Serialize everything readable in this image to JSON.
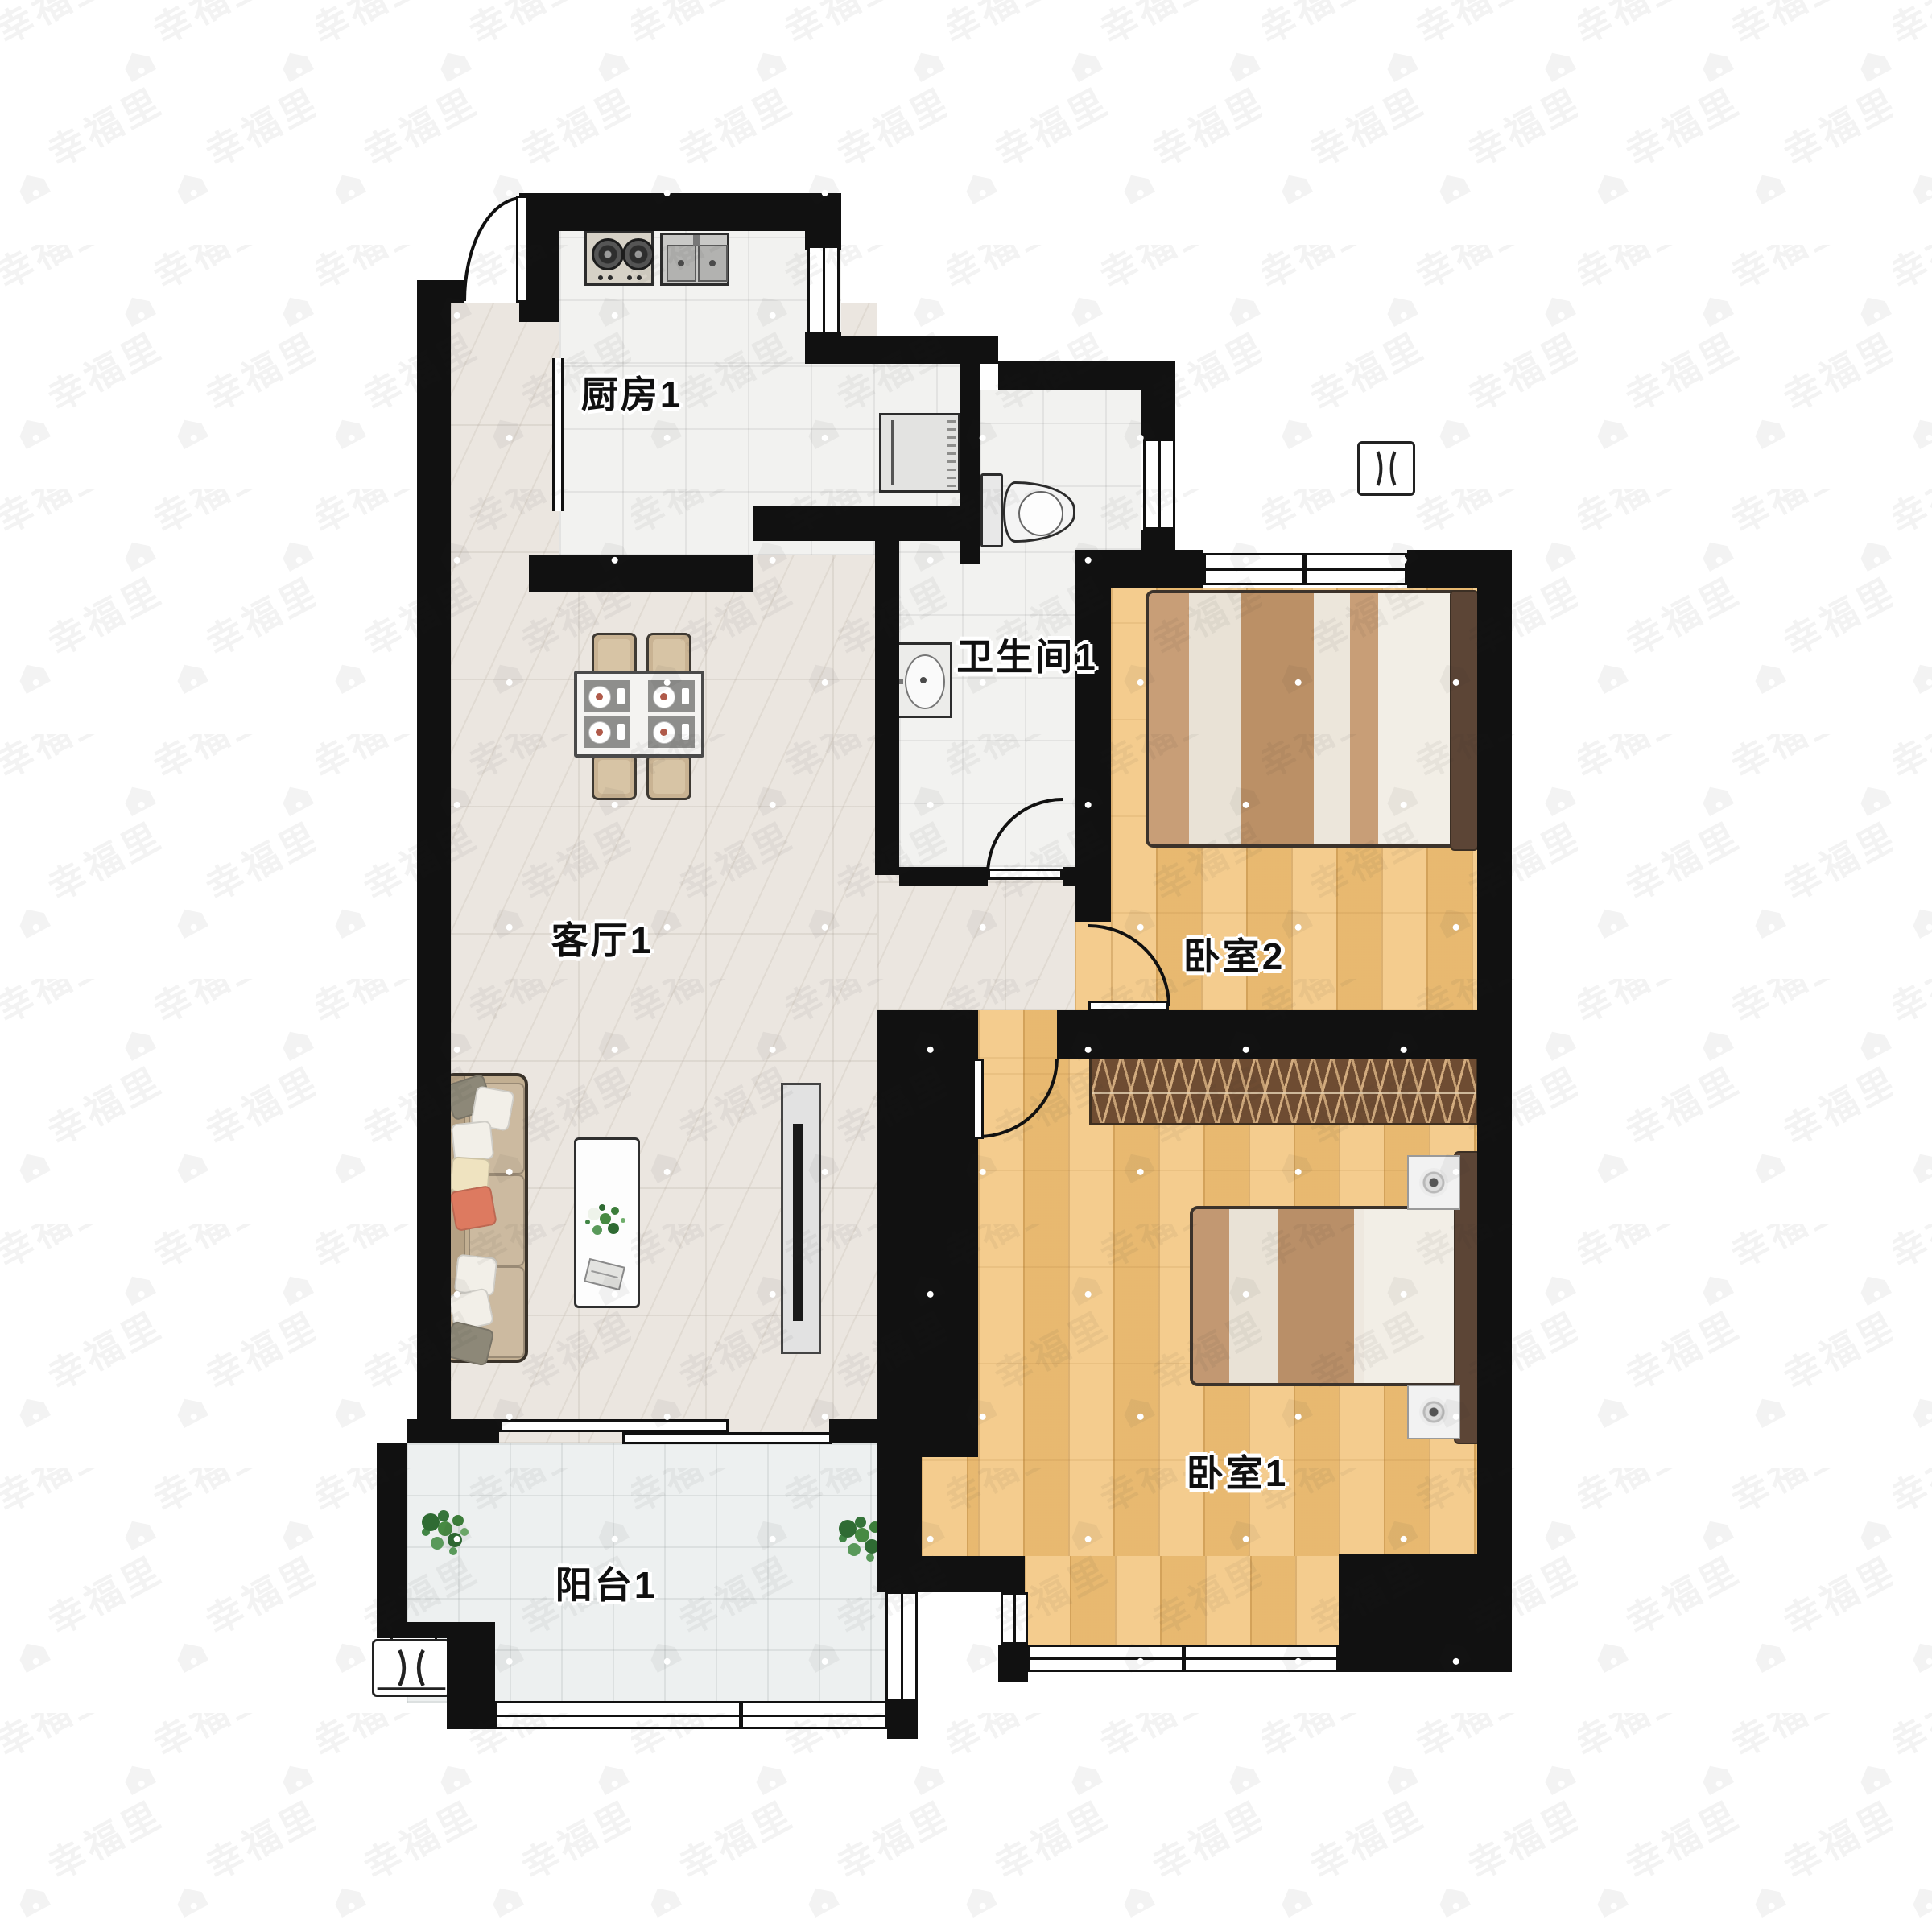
{
  "watermark": {
    "text": "幸福里",
    "icon": "house-icon"
  },
  "rooms": {
    "kitchen": {
      "label": "厨房1"
    },
    "bathroom": {
      "label": "卫生间1"
    },
    "bedroom2": {
      "label": "卧室2"
    },
    "living": {
      "label": "客厅1"
    },
    "bedroom1": {
      "label": "卧室1"
    },
    "balcony": {
      "label": "阳台1"
    }
  },
  "colors": {
    "wall": "#111111",
    "marble_floor": "#ebe6e0",
    "tile_floor": "#f2f2f0",
    "balcony_floor": "#edf0f0",
    "wood_floor": "#f2c47b",
    "wardrobe": "#6e4c32",
    "headboard": "#5c4536",
    "sofa": "#c2af92",
    "accent_pillow": "#dd7a60",
    "plant": "#2f6b33"
  },
  "icons": [
    "door-icon",
    "window-icon",
    "stove-icon",
    "kitchen-sink-icon",
    "fridge-icon",
    "dining-set-icon",
    "toilet-icon",
    "basin-icon",
    "sofa-icon",
    "coffee-table-icon",
    "tv-icon",
    "bed-icon",
    "nightstand-icon",
    "wardrobe-icon",
    "plant-icon",
    "ac-unit-icon",
    "house-icon"
  ]
}
